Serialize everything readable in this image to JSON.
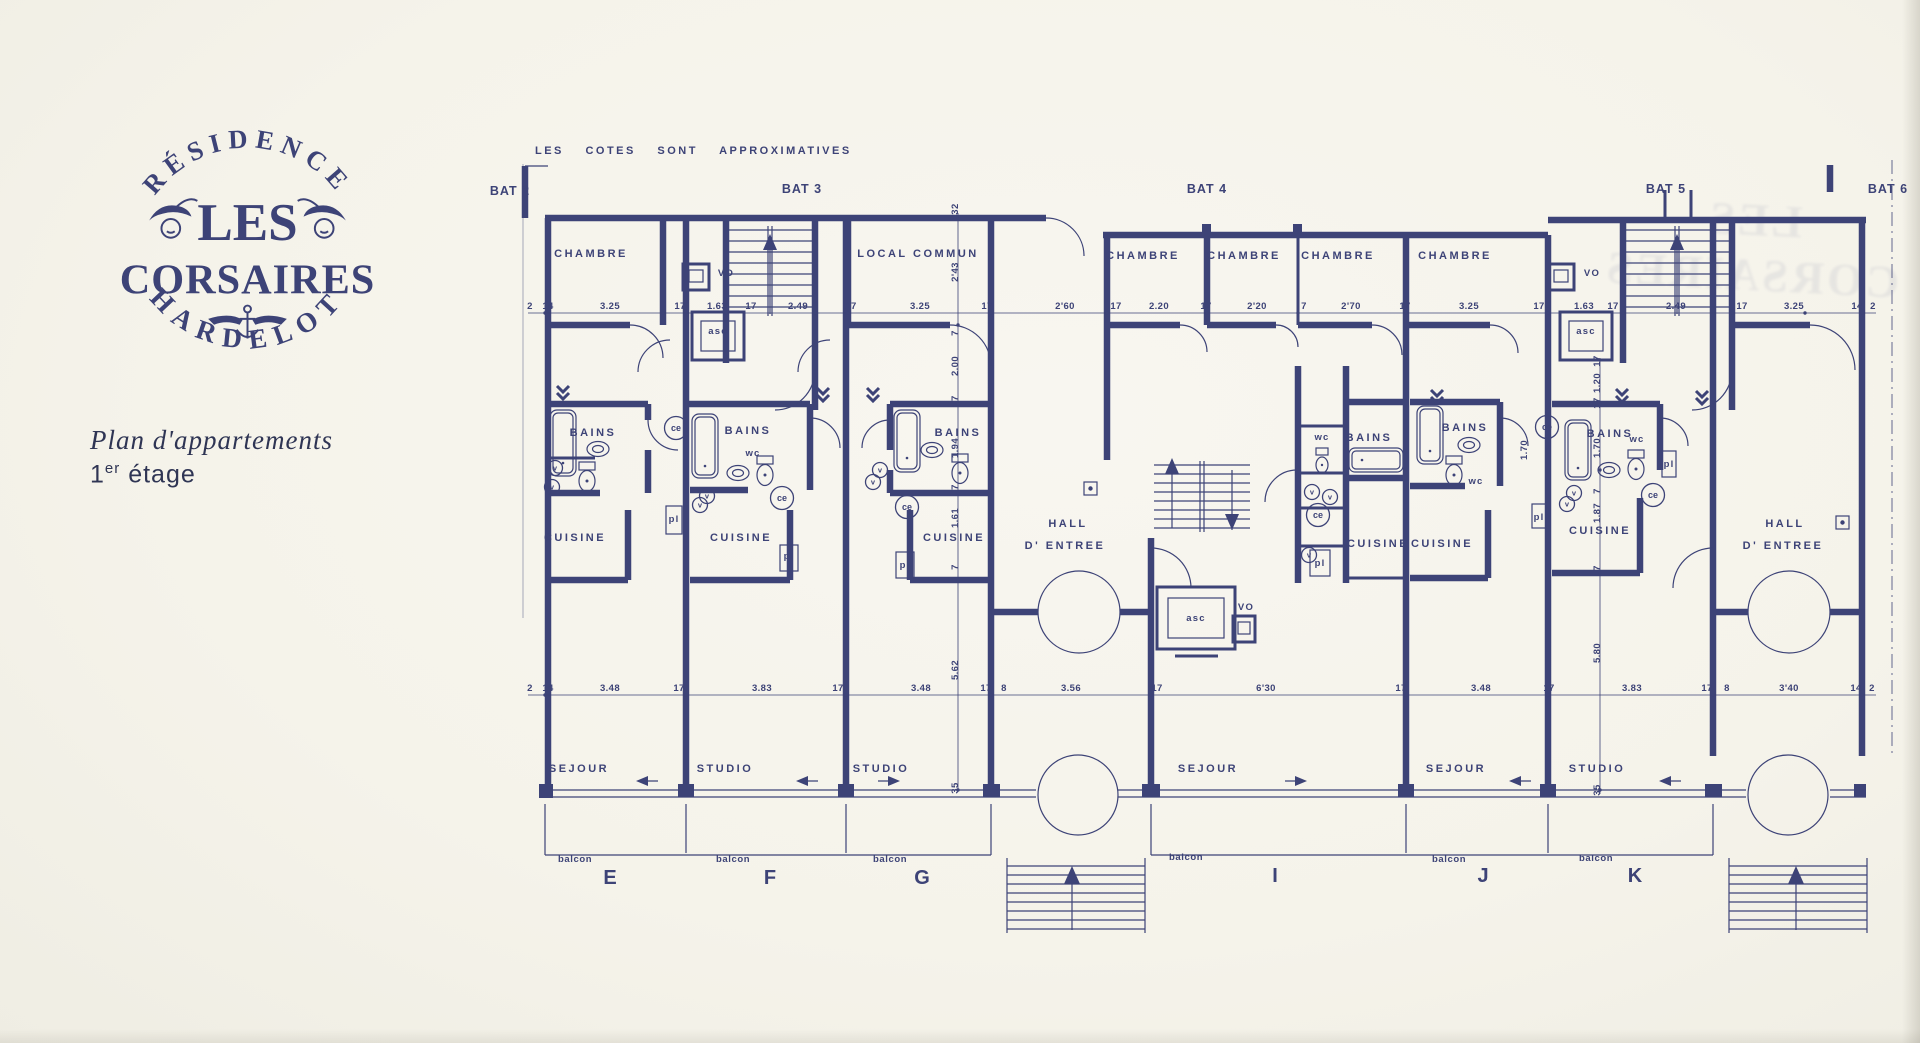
{
  "logo": {
    "residence": "RÉSIDENCE",
    "les": "LES",
    "corsaires": "CORSAIRES",
    "hardelot": "HARDELOT"
  },
  "title": {
    "main": "Plan d'appartements",
    "num": "1",
    "sup": "er",
    "rest": "étage"
  },
  "ghost": {
    "line1": "LES",
    "line2": "CORSAIRES"
  },
  "plan": {
    "note": "LES COTES SONT APPROXIMATIVES",
    "ink_color": "#3d4377",
    "paper_color": "#f5f3ea",
    "bats": [
      {
        "t": "BAT 2",
        "x": 30,
        "y": 77
      },
      {
        "t": "BAT 3",
        "x": 322,
        "y": 75
      },
      {
        "t": "BAT 4",
        "x": 727,
        "y": 75
      },
      {
        "t": "BAT 5",
        "x": 1186,
        "y": 75
      },
      {
        "t": "BAT 6",
        "x": 1408,
        "y": 75
      }
    ],
    "rooms": [
      {
        "t": "CHAMBRE",
        "x": 111,
        "y": 139
      },
      {
        "t": "LOCAL COMMUN",
        "x": 438,
        "y": 139
      },
      {
        "t": "CHAMBRE",
        "x": 663,
        "y": 141
      },
      {
        "t": "CHAMBRE",
        "x": 764,
        "y": 141
      },
      {
        "t": "CHAMBRE",
        "x": 858,
        "y": 141
      },
      {
        "t": "CHAMBRE",
        "x": 975,
        "y": 141
      },
      {
        "t": "BAINS",
        "x": 113,
        "y": 318
      },
      {
        "t": "BAINS",
        "x": 268,
        "y": 316
      },
      {
        "t": "BAINS",
        "x": 478,
        "y": 318
      },
      {
        "t": "BAINS",
        "x": 889,
        "y": 323
      },
      {
        "t": "BAINS",
        "x": 985,
        "y": 313
      },
      {
        "t": "BAINS",
        "x": 1130,
        "y": 319
      },
      {
        "t": "CUISINE",
        "x": 95,
        "y": 423
      },
      {
        "t": "CUISINE",
        "x": 261,
        "y": 423
      },
      {
        "t": "CUISINE",
        "x": 474,
        "y": 423
      },
      {
        "t": "CUISINE",
        "x": 898,
        "y": 429
      },
      {
        "t": "CUISINE",
        "x": 962,
        "y": 429
      },
      {
        "t": "CUISINE",
        "x": 1120,
        "y": 416
      },
      {
        "t": "HALL",
        "x": 588,
        "y": 409
      },
      {
        "t": "D' ENTREE",
        "x": 585,
        "y": 431
      },
      {
        "t": "HALL",
        "x": 1305,
        "y": 409
      },
      {
        "t": "D' ENTREE",
        "x": 1303,
        "y": 431
      },
      {
        "t": "SEJOUR",
        "x": 99,
        "y": 654
      },
      {
        "t": "STUDIO",
        "x": 245,
        "y": 654
      },
      {
        "t": "STUDIO",
        "x": 401,
        "y": 654
      },
      {
        "t": "SEJOUR",
        "x": 728,
        "y": 654
      },
      {
        "t": "SEJOUR",
        "x": 976,
        "y": 654
      },
      {
        "t": "STUDIO",
        "x": 1117,
        "y": 654
      }
    ],
    "small": [
      {
        "t": "VO",
        "x": 246,
        "y": 158
      },
      {
        "t": "asc",
        "x": 238,
        "y": 216
      },
      {
        "t": "VO",
        "x": 1112,
        "y": 158
      },
      {
        "t": "asc",
        "x": 1106,
        "y": 216
      },
      {
        "t": "VO",
        "x": 766,
        "y": 492
      },
      {
        "t": "asc",
        "x": 716,
        "y": 503
      },
      {
        "t": "wc",
        "x": 273,
        "y": 338
      },
      {
        "t": "wc",
        "x": 842,
        "y": 322
      },
      {
        "t": "wc",
        "x": 996,
        "y": 366
      },
      {
        "t": "wc",
        "x": 1157,
        "y": 324
      },
      {
        "t": "pl",
        "x": 194,
        "y": 404
      },
      {
        "t": "pl",
        "x": 309,
        "y": 441
      },
      {
        "t": "pl",
        "x": 425,
        "y": 450
      },
      {
        "t": "pl",
        "x": 840,
        "y": 448
      },
      {
        "t": "pl",
        "x": 1059,
        "y": 402
      },
      {
        "t": "pl",
        "x": 1189,
        "y": 349
      }
    ],
    "ce": [
      {
        "t": "ce",
        "x": 196,
        "y": 310
      },
      {
        "t": "ce",
        "x": 302,
        "y": 380
      },
      {
        "t": "ce",
        "x": 427,
        "y": 389
      },
      {
        "t": "ce",
        "x": 838,
        "y": 397
      },
      {
        "t": "ce",
        "x": 1067,
        "y": 309
      },
      {
        "t": "ce",
        "x": 1173,
        "y": 377
      }
    ],
    "v": [
      {
        "t": "v",
        "x": 75,
        "y": 350
      },
      {
        "t": "v",
        "x": 72,
        "y": 369
      },
      {
        "t": "v",
        "x": 227,
        "y": 378
      },
      {
        "t": "v",
        "x": 220,
        "y": 387
      },
      {
        "t": "v",
        "x": 400,
        "y": 352
      },
      {
        "t": "v",
        "x": 393,
        "y": 364
      },
      {
        "t": "v",
        "x": 832,
        "y": 374
      },
      {
        "t": "v",
        "x": 850,
        "y": 379
      },
      {
        "t": "v",
        "x": 1094,
        "y": 375
      },
      {
        "t": "v",
        "x": 1087,
        "y": 386
      },
      {
        "t": "v",
        "x": 829,
        "y": 437
      }
    ],
    "dims_h": [
      {
        "t": "2",
        "x": 50,
        "y": 191
      },
      {
        "t": "14",
        "x": 68,
        "y": 191
      },
      {
        "t": "3.25",
        "x": 130,
        "y": 191
      },
      {
        "t": "17",
        "x": 200,
        "y": 191
      },
      {
        "t": "1.63",
        "x": 237,
        "y": 191
      },
      {
        "t": "17",
        "x": 271,
        "y": 191
      },
      {
        "t": "2.49",
        "x": 318,
        "y": 191
      },
      {
        "t": "17",
        "x": 371,
        "y": 191
      },
      {
        "t": "3.25",
        "x": 440,
        "y": 191
      },
      {
        "t": "17",
        "x": 507,
        "y": 191
      },
      {
        "t": "2'60",
        "x": 585,
        "y": 191
      },
      {
        "t": "17",
        "x": 636,
        "y": 191
      },
      {
        "t": "2.20",
        "x": 679,
        "y": 191
      },
      {
        "t": "17",
        "x": 726,
        "y": 191
      },
      {
        "t": "2'20",
        "x": 777,
        "y": 191
      },
      {
        "t": "7",
        "x": 824,
        "y": 191
      },
      {
        "t": "2'70",
        "x": 871,
        "y": 191
      },
      {
        "t": "17",
        "x": 925,
        "y": 191
      },
      {
        "t": "3.25",
        "x": 989,
        "y": 191
      },
      {
        "t": "17",
        "x": 1059,
        "y": 191
      },
      {
        "t": "1.63",
        "x": 1104,
        "y": 191
      },
      {
        "t": "17",
        "x": 1133,
        "y": 191
      },
      {
        "t": "2.49",
        "x": 1196,
        "y": 191
      },
      {
        "t": "17",
        "x": 1262,
        "y": 191
      },
      {
        "t": "3.25",
        "x": 1314,
        "y": 191
      },
      {
        "t": "14",
        "x": 1377,
        "y": 191
      },
      {
        "t": "2",
        "x": 1393,
        "y": 191
      },
      {
        "t": "2",
        "x": 50,
        "y": 573
      },
      {
        "t": "14",
        "x": 68,
        "y": 573
      },
      {
        "t": "3.48",
        "x": 130,
        "y": 573
      },
      {
        "t": "17",
        "x": 199,
        "y": 573
      },
      {
        "t": "3.83",
        "x": 282,
        "y": 573
      },
      {
        "t": "17",
        "x": 358,
        "y": 573
      },
      {
        "t": "3.48",
        "x": 441,
        "y": 573
      },
      {
        "t": "17",
        "x": 506,
        "y": 573
      },
      {
        "t": "8",
        "x": 524,
        "y": 573
      },
      {
        "t": "3.56",
        "x": 591,
        "y": 573
      },
      {
        "t": "17",
        "x": 677,
        "y": 573
      },
      {
        "t": "6'30",
        "x": 786,
        "y": 573
      },
      {
        "t": "17",
        "x": 921,
        "y": 573
      },
      {
        "t": "3.48",
        "x": 1001,
        "y": 573
      },
      {
        "t": "17",
        "x": 1069,
        "y": 573
      },
      {
        "t": "3.83",
        "x": 1152,
        "y": 573
      },
      {
        "t": "17",
        "x": 1227,
        "y": 573
      },
      {
        "t": "8",
        "x": 1247,
        "y": 573
      },
      {
        "t": "3'40",
        "x": 1309,
        "y": 573
      },
      {
        "t": "14",
        "x": 1376,
        "y": 573
      },
      {
        "t": "2",
        "x": 1392,
        "y": 573
      }
    ],
    "dims_v": [
      {
        "t": "32",
        "x": 478,
        "y": 91,
        "r": 1
      },
      {
        "t": "2'43",
        "x": 478,
        "y": 154,
        "r": 1
      },
      {
        "t": "7",
        "x": 478,
        "y": 215,
        "r": 1
      },
      {
        "t": "2.00",
        "x": 478,
        "y": 248,
        "r": 1
      },
      {
        "t": "17",
        "x": 478,
        "y": 283,
        "r": 1
      },
      {
        "t": "1.94",
        "x": 478,
        "y": 330,
        "r": 1
      },
      {
        "t": "7",
        "x": 478,
        "y": 369,
        "r": 1
      },
      {
        "t": "1.61",
        "x": 478,
        "y": 400,
        "r": 1
      },
      {
        "t": "7",
        "x": 478,
        "y": 449,
        "r": 1
      },
      {
        "t": "5.62",
        "x": 478,
        "y": 552,
        "r": 1
      },
      {
        "t": "35",
        "x": 478,
        "y": 670,
        "r": 1
      },
      {
        "t": "17",
        "x": 1120,
        "y": 243,
        "r": 1
      },
      {
        "t": "1.20",
        "x": 1120,
        "y": 265,
        "r": 1
      },
      {
        "t": "17",
        "x": 1120,
        "y": 285,
        "r": 1
      },
      {
        "t": "1.70",
        "x": 1120,
        "y": 330,
        "r": 1
      },
      {
        "t": "7",
        "x": 1120,
        "y": 373,
        "r": 1
      },
      {
        "t": "1.87",
        "x": 1120,
        "y": 395,
        "r": 1
      },
      {
        "t": "7",
        "x": 1120,
        "y": 450,
        "r": 1
      },
      {
        "t": "5.80",
        "x": 1120,
        "y": 535,
        "r": 1
      },
      {
        "t": "35",
        "x": 1120,
        "y": 672,
        "r": 1
      },
      {
        "t": "1.70",
        "x": 1047,
        "y": 332,
        "r": 1
      }
    ],
    "letters": [
      {
        "t": "E",
        "x": 130,
        "y": 766
      },
      {
        "t": "F",
        "x": 290,
        "y": 766
      },
      {
        "t": "G",
        "x": 442,
        "y": 766
      },
      {
        "t": "I",
        "x": 795,
        "y": 764
      },
      {
        "t": "J",
        "x": 1003,
        "y": 764
      },
      {
        "t": "K",
        "x": 1155,
        "y": 764
      }
    ],
    "balcons": [
      {
        "t": "balcon",
        "x": 78,
        "y": 744
      },
      {
        "t": "balcon",
        "x": 236,
        "y": 744
      },
      {
        "t": "balcon",
        "x": 393,
        "y": 744
      },
      {
        "t": "balcon",
        "x": 689,
        "y": 742
      },
      {
        "t": "balcon",
        "x": 952,
        "y": 744
      },
      {
        "t": "balcon",
        "x": 1099,
        "y": 743
      }
    ]
  }
}
